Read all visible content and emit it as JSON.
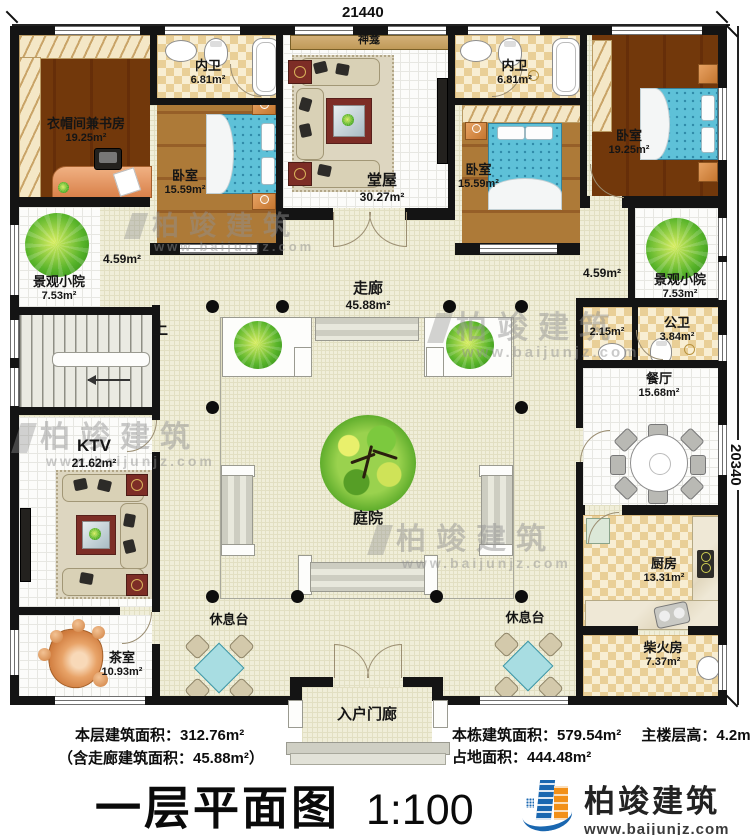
{
  "dimensions": {
    "top": "21440",
    "right": "20340"
  },
  "rooms": {
    "cloakroom_study": {
      "name": "衣帽间兼书房",
      "area": "19.25m²"
    },
    "ensuite_left": {
      "name": "内卫",
      "area": "6.81m²"
    },
    "bedroom_left": {
      "name": "卧室",
      "area": "15.59m²"
    },
    "shrine": {
      "name": "神龛"
    },
    "main_hall": {
      "name": "堂屋",
      "area": "30.27m²"
    },
    "ensuite_right": {
      "name": "内卫",
      "area": "6.81m²"
    },
    "bedroom_mid": {
      "name": "卧室",
      "area": "15.59m²"
    },
    "bedroom_right": {
      "name": "卧室",
      "area": "19.25m²"
    },
    "scenic_yard_left": {
      "name": "景观小院",
      "area": "7.53m²"
    },
    "scenic_yard_right": {
      "name": "景观小院",
      "area": "7.53m²"
    },
    "passage_left": {
      "area": "4.59m²"
    },
    "passage_right": {
      "area": "4.59m²"
    },
    "corridor": {
      "name": "走廊",
      "area": "45.88m²"
    },
    "stair_up": {
      "name": "上"
    },
    "wash_area": {
      "area": "2.15m²"
    },
    "public_toilet": {
      "name": "公卫",
      "area": "3.84m²"
    },
    "dining": {
      "name": "餐厅",
      "area": "15.68m²"
    },
    "ktv": {
      "name": "KTV",
      "area": "21.62m²"
    },
    "inner_courtyard": {
      "name": "庭院"
    },
    "kitchen": {
      "name": "厨房",
      "area": "13.31m²"
    },
    "tea_room": {
      "name": "茶室",
      "area": "10.93m²"
    },
    "rest_platform_left": {
      "name": "休息台"
    },
    "rest_platform_right": {
      "name": "休息台"
    },
    "firewood_room": {
      "name": "柴火房",
      "area": "7.37m²"
    },
    "entry_porch": {
      "name": "入户门廊"
    }
  },
  "stats": {
    "floor_area": "本层建筑面积：312.76m²",
    "incl_corridor": "（含走廊建筑面积：45.88m²）",
    "building_area": "本栋建筑面积：579.54m²",
    "main_floor_height": "主楼层高：4.2m",
    "land_area": "占地面积：444.48m²"
  },
  "title": {
    "text": "一层平面图",
    "scale": "1:100"
  },
  "brand": {
    "name": "柏竣建筑",
    "website": "www.baijunjz.com"
  },
  "watermark": {
    "name": "柏竣建筑",
    "website": "www.baijunjz.com"
  },
  "colors": {
    "wall": "#141414",
    "wood_floor": "#a87434",
    "tile_cream": "#f0eed9",
    "checker_tan": "#e9cf97",
    "bed_blue": "#5ec1d8",
    "rug_red": "#7d2d26",
    "brand_blue": "#1a67b0",
    "brand_orange": "#f29018"
  }
}
